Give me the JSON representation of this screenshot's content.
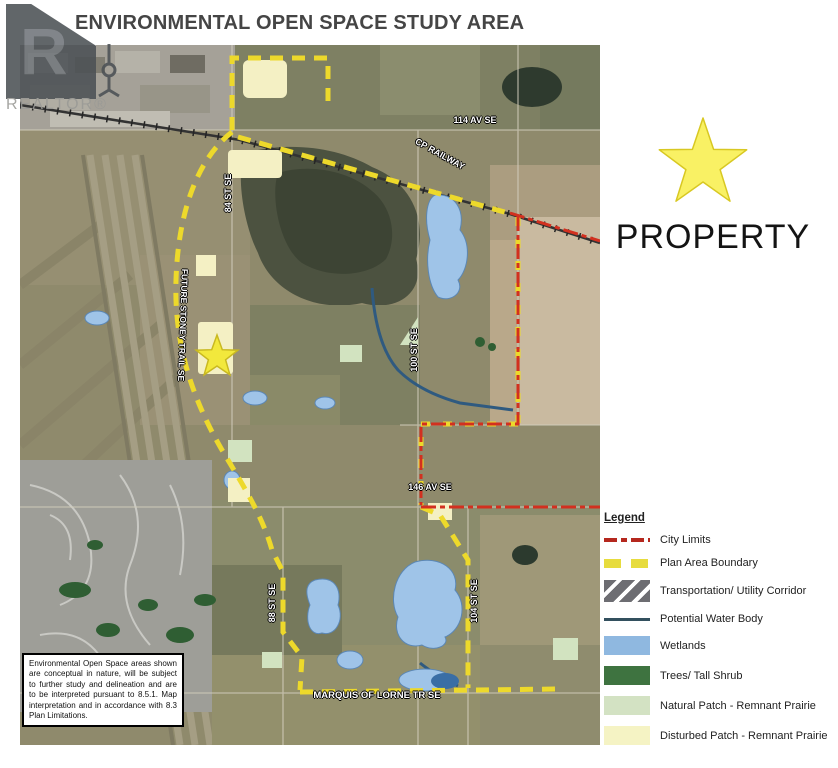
{
  "title": "ENVIRONMENTAL OPEN SPACE STUDY AREA",
  "watermark": {
    "letter": "R",
    "text": "REALTOR®"
  },
  "property_marker": {
    "label": "PROPERTY",
    "icon": "star",
    "star_color": "#f9f164"
  },
  "map": {
    "labels": [
      {
        "text": "114 AV SE"
      },
      {
        "text": "CP RAILWAY"
      },
      {
        "text": "84 ST SE"
      },
      {
        "text": "FUTURE STONEY TRAIL SE"
      },
      {
        "text": "100 ST SE"
      },
      {
        "text": "146 AV SE"
      },
      {
        "text": "88 ST SE"
      },
      {
        "text": "104 ST SE"
      },
      {
        "text": "MARQUIS OF LORNE TR SE"
      }
    ],
    "disclaimer": "Environmental Open Space areas shown are conceptual in nature, will be subject to further study and delineation and are to be interpreted pursuant to 8.5.1. Map interpretation and in accordance with 8.3 Plan Limitations."
  },
  "legend": {
    "heading": "Legend",
    "items": [
      {
        "label": "City Limits",
        "swatch": "red-dash-dot-line",
        "color": "#b5281e"
      },
      {
        "label": "Plan Area Boundary",
        "swatch": "yellow-dash-line",
        "color": "#e7dc3e"
      },
      {
        "label": "Transportation/ Utility Corridor",
        "swatch": "gray-hatched-box",
        "color": "#6d6d72"
      },
      {
        "label": "Potential Water Body",
        "swatch": "blue-line",
        "color": "#33505e"
      },
      {
        "label": "Wetlands",
        "swatch": "fill",
        "color": "#8fb8e0"
      },
      {
        "label": "Trees/ Tall Shrub",
        "swatch": "fill",
        "color": "#3e7340"
      },
      {
        "label": "Natural Patch - Remnant Prairie",
        "swatch": "fill",
        "color": "#d3e2c3"
      },
      {
        "label": "Disturbed Patch - Remnant Prairie",
        "swatch": "fill",
        "color": "#f5f3c4"
      }
    ]
  }
}
